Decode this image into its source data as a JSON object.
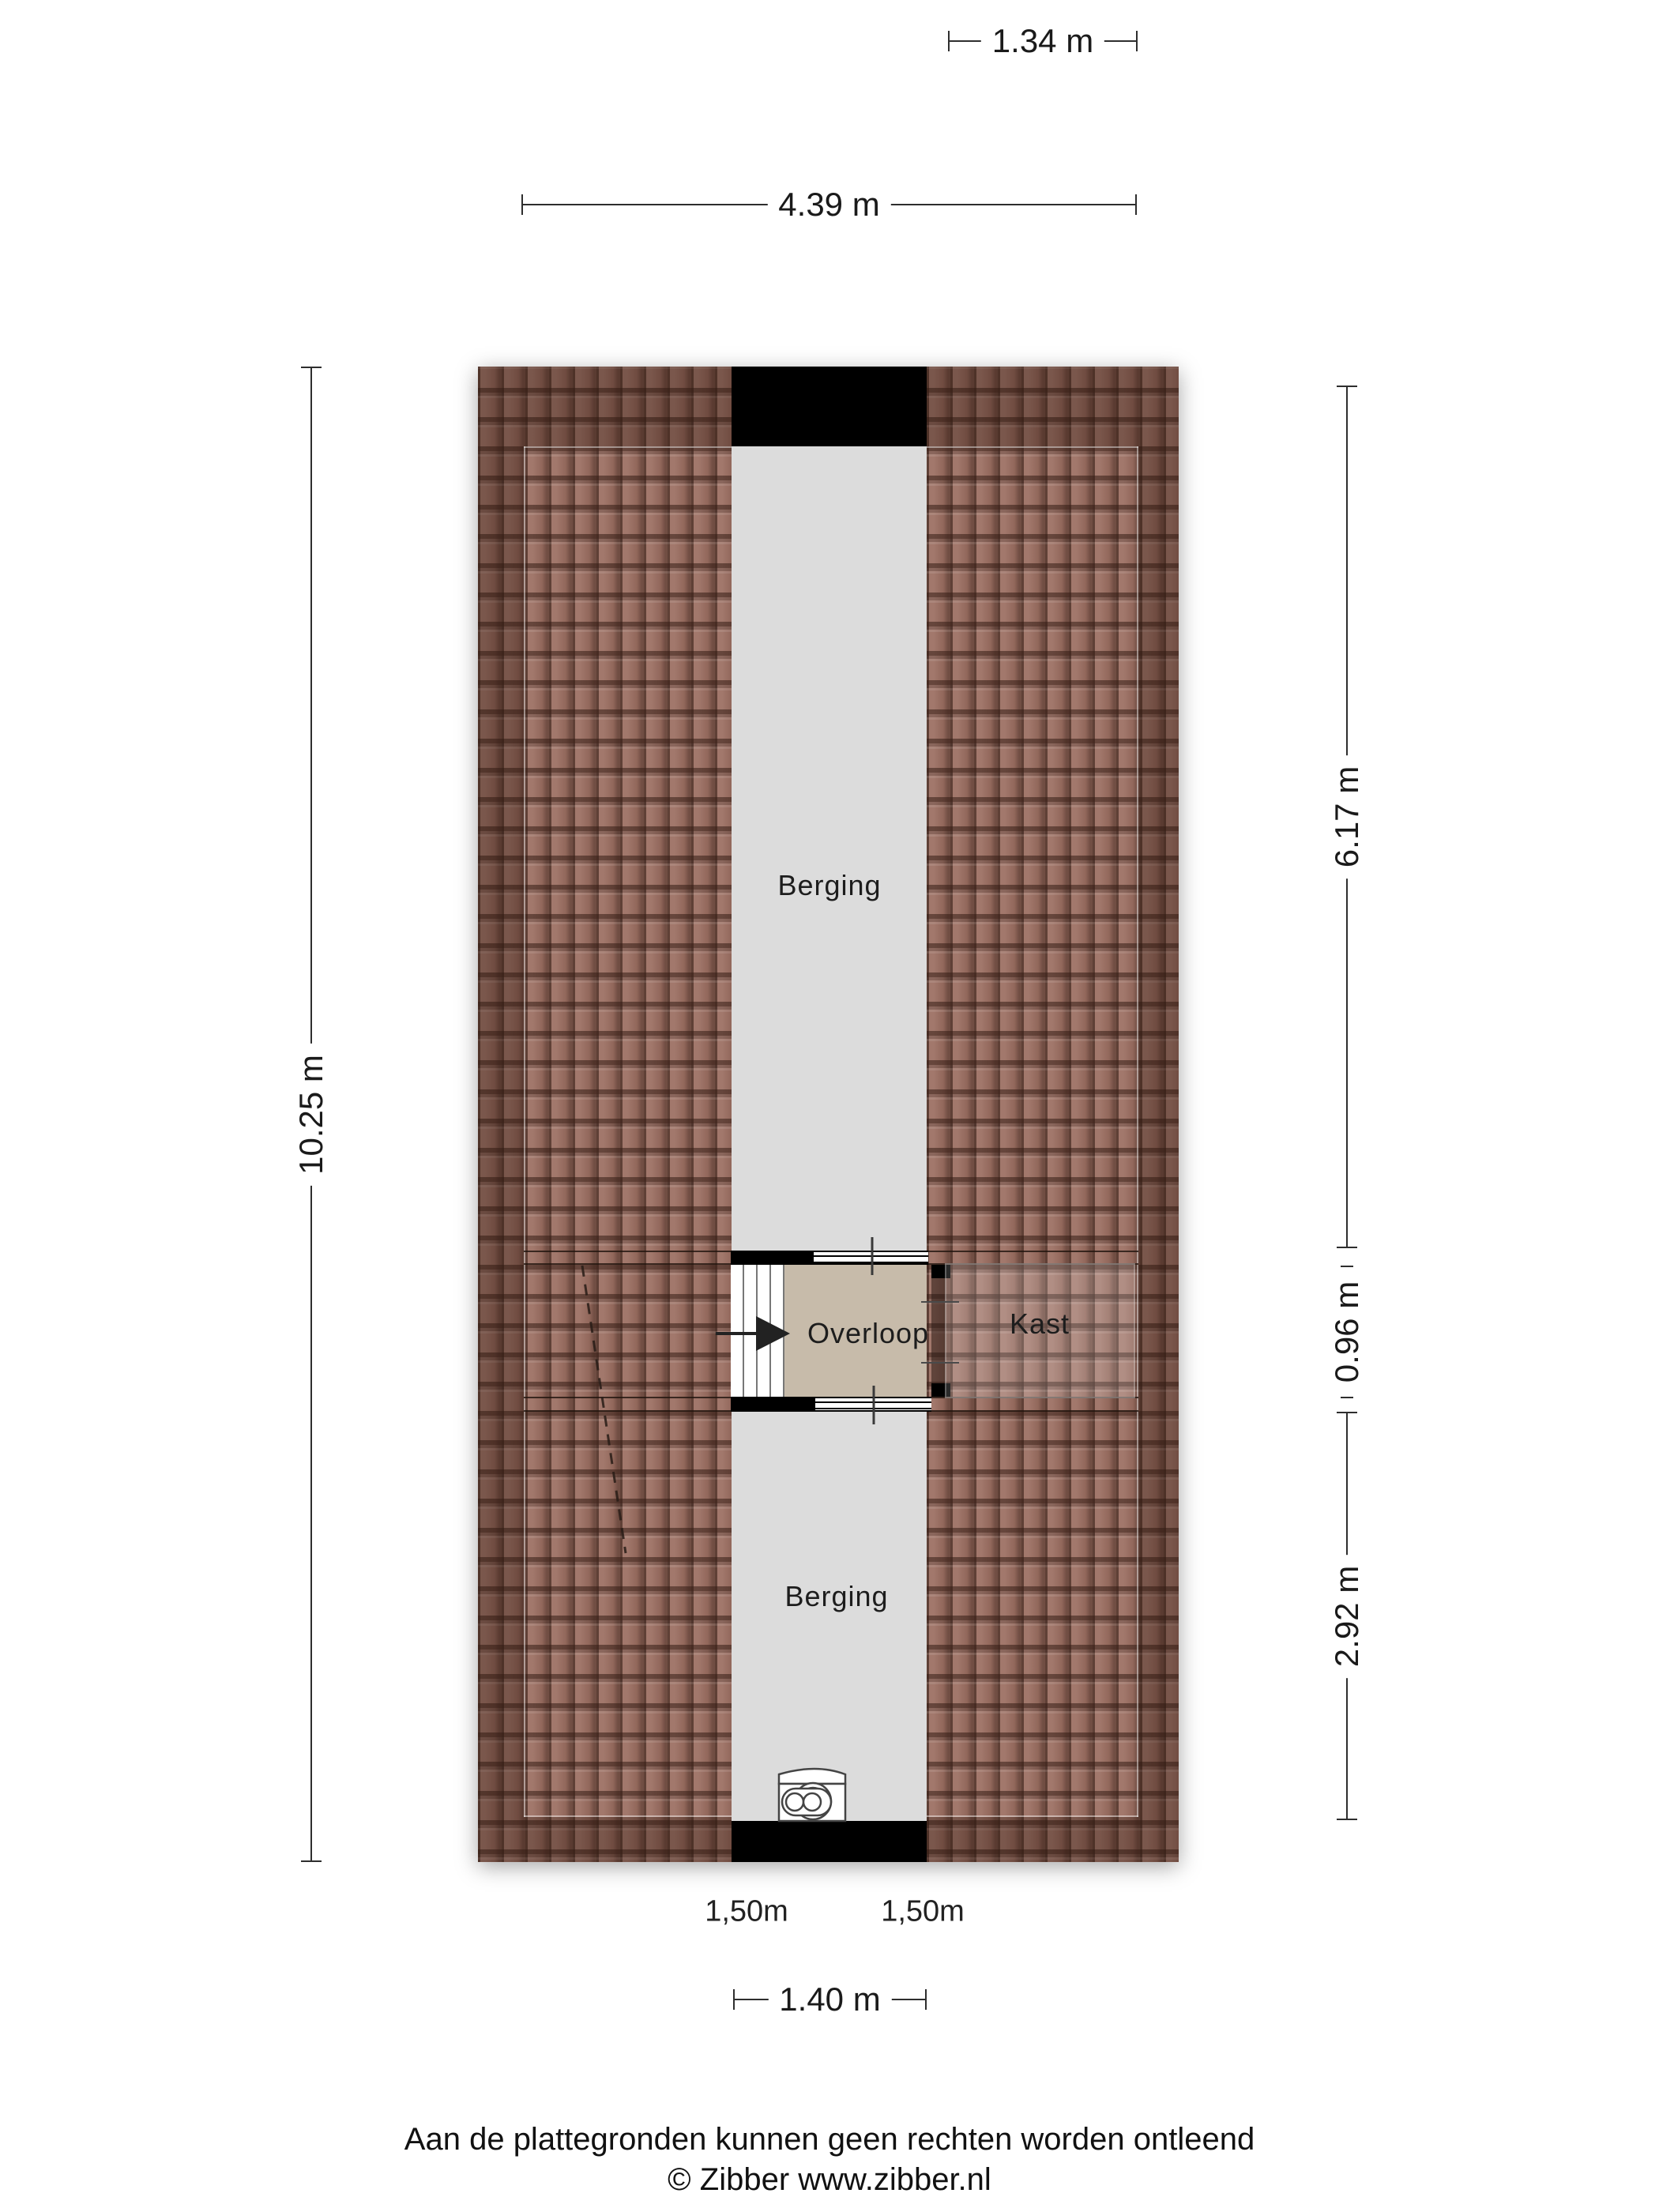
{
  "floorplan": {
    "rooms": {
      "berging_top": "Berging",
      "overloop": "Overloop",
      "kast": "Kast",
      "berging_bottom": "Berging"
    },
    "headroom_labels": {
      "left": "1,50m",
      "right": "1,50m"
    },
    "dimensions": {
      "top_small": "1.34 m",
      "top_wide": "4.39 m",
      "left_full": "10.25 m",
      "right_top": "6.17 m",
      "right_middle": "0.96 m",
      "right_bottom": "2.92 m",
      "bottom": "1.40 m"
    },
    "colors": {
      "roof_tile": "#9b6e61",
      "floor_gray": "#dcdcdc",
      "overloop_beige": "#c7bbaa",
      "wall_black": "#000000"
    },
    "icons": {
      "appliance": "washing-machine-icon"
    }
  },
  "footer": {
    "disclaimer": "Aan de plattegronden kunnen geen rechten worden ontleend",
    "copyright": "© Zibber www.zibber.nl"
  }
}
